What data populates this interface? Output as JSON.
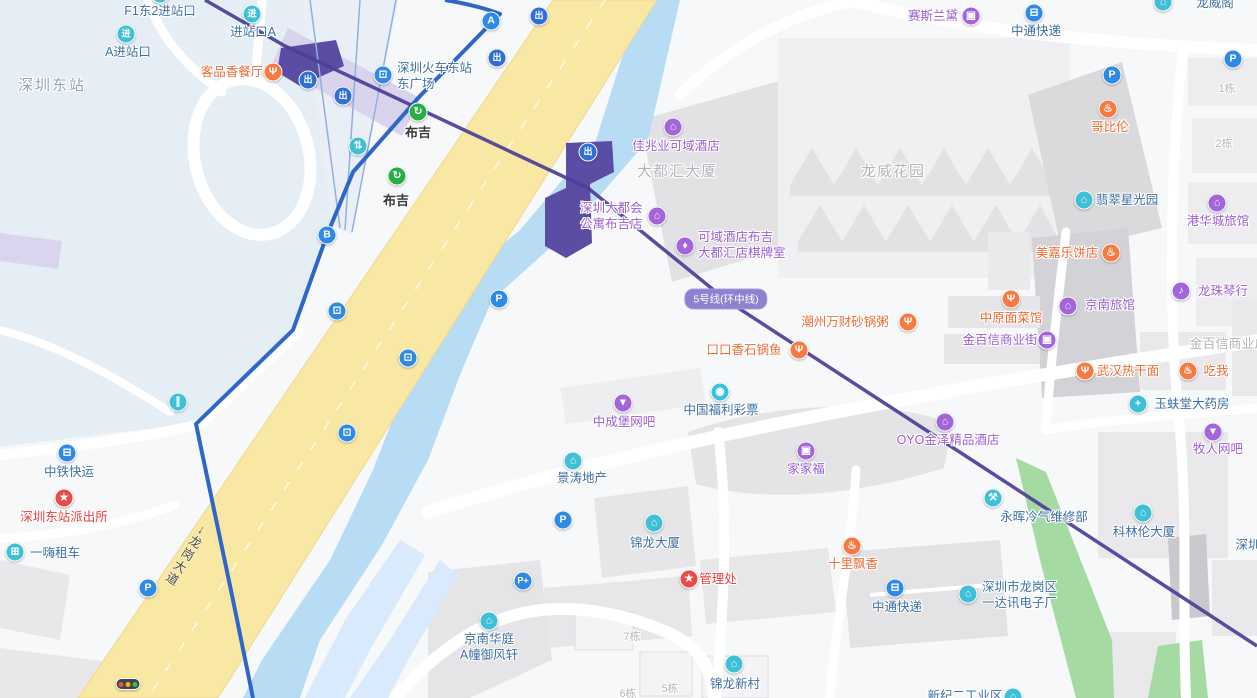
{
  "map_title": "深圳东站 / 布吉站周边地图",
  "palette": {
    "icon": {
      "blue": "#2f8ae4",
      "teal": "#3fc0d6",
      "green": "#27ae45",
      "purple": "#a465d8",
      "orange": "#f57b43",
      "red": "#e84c4a",
      "exit": "#2f6fd6"
    },
    "text": {
      "blue": "#3e6fa3",
      "purple": "#9c5ed2",
      "orange": "#ed6c35",
      "red": "#e3403e",
      "dark": "#38383a",
      "gray": "#b4b4ba",
      "grayblue": "#8fa7b5"
    },
    "road_yellow": "#f9e7a4",
    "river_blue": "#b9dcf5",
    "park_green": "#a5daa3",
    "metro_purple": "#4a3e96",
    "station_purple": "#5a4da3",
    "yard_blue": "#e4eef4"
  },
  "badge": {
    "text": "5号线(环中线)"
  },
  "road": {
    "name": "龙岗大道",
    "arrow": "↓"
  },
  "traffic_light": {
    "x": 128,
    "y": 684,
    "colors": [
      "#e85548",
      "#f2b01e",
      "#3dbb4e"
    ]
  },
  "pois": [
    {
      "id": "f1-east2-entrance",
      "lines": [
        "F1东2进站口"
      ],
      "align": "c",
      "x": 160,
      "y": 11,
      "tc": "blue",
      "icon": {
        "n": "entrance-icon",
        "g": "进",
        "c": "teal",
        "x": 160,
        "y": -6
      }
    },
    {
      "id": "entrance-a-top",
      "lines": [
        "进站口A"
      ],
      "align": "c",
      "x": 253,
      "y": 32,
      "tc": "blue",
      "icon": {
        "n": "entrance-icon",
        "g": "进",
        "c": "teal",
        "x": 252,
        "y": 14
      }
    },
    {
      "id": "a-entrance",
      "lines": [
        "A进站口"
      ],
      "align": "c",
      "x": 128,
      "y": 52,
      "tc": "blue",
      "icon": {
        "n": "entrance-icon",
        "g": "进",
        "c": "teal",
        "x": 126,
        "y": 34
      }
    },
    {
      "id": "shenzhen-east-station-area",
      "lines": [
        "深圳东站"
      ],
      "align": "c",
      "x": 52,
      "y": 86,
      "tc": "grayblue",
      "fs": 15,
      "ls": 2
    },
    {
      "id": "kepinxiang-restaurant",
      "lines": [
        "客品香餐厅"
      ],
      "align": "c",
      "x": 232,
      "y": 72,
      "tc": "orange",
      "icon": {
        "n": "restaurant-icon",
        "g": "Ψ",
        "c": "orange",
        "x": 273,
        "y": 72
      }
    },
    {
      "id": "east-square",
      "lines": [
        "深圳火车东站",
        "东广场"
      ],
      "align": "l",
      "x": 397,
      "y": 68,
      "tc": "blue",
      "icon": {
        "n": "bus-station-icon",
        "g": "⊡",
        "c": "blue",
        "x": 383,
        "y": 75
      }
    },
    {
      "id": "buji-metro-station-1",
      "lines": [
        "布吉"
      ],
      "align": "c",
      "x": 418,
      "y": 133,
      "tc": "dark",
      "fs": 13,
      "bold": true,
      "icon": {
        "n": "metro-icon",
        "g": "↻",
        "c": "green",
        "x": 418,
        "y": 112
      }
    },
    {
      "id": "buji-metro-station-2",
      "lines": [
        "布吉"
      ],
      "align": "c",
      "x": 396,
      "y": 201,
      "tc": "dark",
      "fs": 13,
      "bold": true,
      "icon": {
        "n": "metro-icon",
        "g": "↻",
        "c": "green",
        "x": 397,
        "y": 176
      }
    },
    {
      "id": "metropolis-apartment",
      "lines": [
        "深圳大都会",
        "公寓布吉店"
      ],
      "align": "l",
      "x": 580,
      "y": 208,
      "tc": "purple",
      "icon": {
        "n": "hotel-icon",
        "g": "⌂",
        "c": "purple",
        "x": 657,
        "y": 216
      }
    },
    {
      "id": "dadouhui-tower-area",
      "lines": [
        "大都汇大厦"
      ],
      "align": "c",
      "x": 677,
      "y": 172,
      "tc": "gray",
      "fs": 15,
      "ls": 1
    },
    {
      "id": "jiazhaoye-keyu-hotel",
      "lines": [
        "佳兆业可域酒店"
      ],
      "align": "c",
      "x": 676,
      "y": 146,
      "tc": "purple",
      "icon": {
        "n": "hotel-icon",
        "g": "⌂",
        "c": "purple",
        "x": 673,
        "y": 127
      }
    },
    {
      "id": "keyu-hotel-chess-room",
      "lines": [
        "可域酒店布吉",
        "大都汇店棋牌室"
      ],
      "align": "l",
      "x": 698,
      "y": 237,
      "tc": "purple",
      "icon": {
        "n": "poker-room-icon",
        "g": "♦",
        "c": "purple",
        "x": 685,
        "y": 246
      }
    },
    {
      "id": "longwei-garden-area",
      "lines": [
        "龙威花园"
      ],
      "align": "c",
      "x": 893,
      "y": 172,
      "tc": "gray",
      "fs": 15,
      "ls": 1
    },
    {
      "id": "saisilandai-cosmetics",
      "lines": [
        "赛斯兰黛"
      ],
      "align": "c",
      "x": 933,
      "y": 16,
      "tc": "purple",
      "icon": {
        "n": "cosmetics-icon",
        "g": "▣",
        "c": "purple",
        "x": 971,
        "y": 16
      }
    },
    {
      "id": "zhongtong-express-top",
      "lines": [
        "中通快递"
      ],
      "align": "c",
      "x": 1036,
      "y": 31,
      "tc": "blue",
      "icon": {
        "n": "truck-icon",
        "g": "⊟",
        "c": "blue",
        "x": 1034,
        "y": 13
      }
    },
    {
      "id": "longweige-partial",
      "lines": [
        "龙威阁"
      ],
      "align": "c",
      "x": 1215,
      "y": 3,
      "tc": "blue",
      "icon": {
        "n": "building-icon",
        "g": "⌂",
        "c": "teal",
        "x": 1163,
        "y": 2
      }
    },
    {
      "id": "gebilun-bakery",
      "lines": [
        "哥比伦"
      ],
      "align": "c",
      "x": 1110,
      "y": 127,
      "tc": "orange",
      "icon": {
        "n": "bakery-icon",
        "g": "♨",
        "c": "orange",
        "x": 1108,
        "y": 109
      }
    },
    {
      "id": "building-no-1",
      "lines": [
        "1栋"
      ],
      "align": "c",
      "x": 1227,
      "y": 89,
      "tc": "gray",
      "fs": 11
    },
    {
      "id": "building-no-2",
      "lines": [
        "2栋"
      ],
      "align": "c",
      "x": 1224,
      "y": 144,
      "tc": "gray",
      "fs": 11
    },
    {
      "id": "feicui-starlight-park",
      "lines": [
        "翡翠星光园"
      ],
      "align": "c",
      "x": 1127,
      "y": 200,
      "tc": "blue",
      "icon": {
        "n": "building-icon",
        "g": "⌂",
        "c": "teal",
        "x": 1084,
        "y": 200
      }
    },
    {
      "id": "ganghuacheng-hotel",
      "lines": [
        "港华城旅馆"
      ],
      "align": "c",
      "x": 1218,
      "y": 221,
      "tc": "purple",
      "icon": {
        "n": "hotel-icon",
        "g": "⌂",
        "c": "purple",
        "x": 1217,
        "y": 203
      }
    },
    {
      "id": "meijiale-bakery",
      "lines": [
        "美嘉乐饼店"
      ],
      "align": "c",
      "x": 1067,
      "y": 253,
      "tc": "orange",
      "icon": {
        "n": "bakery-icon",
        "g": "♨",
        "c": "orange",
        "x": 1111,
        "y": 253
      }
    },
    {
      "id": "jingnan-hotel",
      "lines": [
        "京南旅馆"
      ],
      "align": "c",
      "x": 1110,
      "y": 305,
      "tc": "purple",
      "icon": {
        "n": "hotel-icon",
        "g": "⌂",
        "c": "purple",
        "x": 1068,
        "y": 306
      }
    },
    {
      "id": "longzhu-piano-store",
      "lines": [
        "龙珠琴行"
      ],
      "align": "c",
      "x": 1223,
      "y": 291,
      "tc": "purple",
      "icon": {
        "n": "music-store-icon",
        "g": "♪",
        "c": "purple",
        "x": 1181,
        "y": 291
      }
    },
    {
      "id": "zhongyuan-noodle-restaurant",
      "lines": [
        "中原面菜馆"
      ],
      "align": "c",
      "x": 1011,
      "y": 318,
      "tc": "orange",
      "icon": {
        "n": "restaurant-icon",
        "g": "Ψ",
        "c": "orange",
        "x": 1011,
        "y": 299
      }
    },
    {
      "id": "jinbaixin-commercial-street",
      "lines": [
        "金百信商业街"
      ],
      "align": "c",
      "x": 1000,
      "y": 340,
      "tc": "purple",
      "icon": {
        "n": "shopping-icon",
        "g": "▣",
        "c": "purple",
        "x": 1047,
        "y": 340
      }
    },
    {
      "id": "jinbaixin-plaza-partial",
      "lines": [
        "金百信商业广场"
      ],
      "align": "c",
      "x": 1235,
      "y": 344,
      "tc": "gray",
      "fs": 13
    },
    {
      "id": "chaozhou-casserole-porridge",
      "lines": [
        "潮州万财砂锅粥"
      ],
      "align": "c",
      "x": 845,
      "y": 322,
      "tc": "orange",
      "icon": {
        "n": "restaurant-icon",
        "g": "Ψ",
        "c": "orange",
        "x": 908,
        "y": 322
      }
    },
    {
      "id": "koukouxiang-stone-pot-fish",
      "lines": [
        "口口香石锅鱼"
      ],
      "align": "c",
      "x": 744,
      "y": 350,
      "tc": "orange",
      "icon": {
        "n": "restaurant-icon",
        "g": "Ψ",
        "c": "orange",
        "x": 799,
        "y": 350
      }
    },
    {
      "id": "wuhan-hot-dry-noodles",
      "lines": [
        "武汉热干面"
      ],
      "align": "c",
      "x": 1128,
      "y": 371,
      "tc": "orange",
      "icon": {
        "n": "restaurant-icon",
        "g": "Ψ",
        "c": "orange",
        "x": 1085,
        "y": 371
      }
    },
    {
      "id": "chiwo-restaurant",
      "lines": [
        "吃我"
      ],
      "align": "c",
      "x": 1216,
      "y": 371,
      "tc": "orange",
      "icon": {
        "n": "snack-icon",
        "g": "♨",
        "c": "orange",
        "x": 1188,
        "y": 371
      }
    },
    {
      "id": "yufutang-pharmacy",
      "lines": [
        "玉蚨堂大药房"
      ],
      "align": "c",
      "x": 1192,
      "y": 404,
      "tc": "blue",
      "icon": {
        "n": "pharmacy-icon",
        "g": "+",
        "c": "teal",
        "x": 1138,
        "y": 404
      }
    },
    {
      "id": "muren-internet-bar",
      "lines": [
        "牧人网吧"
      ],
      "align": "c",
      "x": 1218,
      "y": 449,
      "tc": "purple",
      "icon": {
        "n": "pin-icon",
        "g": "▼",
        "c": "purple",
        "x": 1213,
        "y": 432
      }
    },
    {
      "id": "zhongchengbao-internet-bar",
      "lines": [
        "中成堡网吧"
      ],
      "align": "c",
      "x": 624,
      "y": 422,
      "tc": "purple",
      "icon": {
        "n": "pin-icon",
        "g": "▼",
        "c": "purple",
        "x": 623,
        "y": 403
      }
    },
    {
      "id": "china-welfare-lottery",
      "lines": [
        "中国福利彩票"
      ],
      "align": "c",
      "x": 721,
      "y": 410,
      "tc": "blue",
      "icon": {
        "n": "lottery-icon",
        "g": "◉",
        "c": "teal",
        "x": 720,
        "y": 392
      }
    },
    {
      "id": "jingtao-real-estate",
      "lines": [
        "景涛地产"
      ],
      "align": "c",
      "x": 582,
      "y": 478,
      "tc": "blue",
      "icon": {
        "n": "building-icon",
        "g": "⌂",
        "c": "teal",
        "x": 573,
        "y": 461
      }
    },
    {
      "id": "jiajiafu-store",
      "lines": [
        "家家福"
      ],
      "align": "c",
      "x": 806,
      "y": 469,
      "tc": "purple",
      "icon": {
        "n": "shopping-icon",
        "g": "▣",
        "c": "purple",
        "x": 806,
        "y": 451
      }
    },
    {
      "id": "oyo-jinze-hotel",
      "lines": [
        "OYO金泽精品酒店"
      ],
      "align": "c",
      "x": 948,
      "y": 440,
      "tc": "purple",
      "icon": {
        "n": "hotel-icon",
        "g": "⌂",
        "c": "purple",
        "x": 945,
        "y": 422
      }
    },
    {
      "id": "yonghui-ac-repair",
      "lines": [
        "永晖冷气维修部"
      ],
      "align": "c",
      "x": 1044,
      "y": 517,
      "tc": "blue",
      "icon": {
        "n": "wrench-icon",
        "g": "⚒",
        "c": "teal",
        "x": 993,
        "y": 498
      }
    },
    {
      "id": "kelinlun-tower",
      "lines": [
        "科林伦大厦"
      ],
      "align": "c",
      "x": 1144,
      "y": 532,
      "tc": "blue",
      "icon": {
        "n": "building-icon",
        "g": "⌂",
        "c": "teal",
        "x": 1143,
        "y": 513
      }
    },
    {
      "id": "shenzhen-partial-right",
      "lines": [
        "深圳"
      ],
      "align": "c",
      "x": 1248,
      "y": 545,
      "tc": "blue"
    },
    {
      "id": "zhongtie-express",
      "lines": [
        "中铁快运"
      ],
      "align": "c",
      "x": 69,
      "y": 472,
      "tc": "blue",
      "icon": {
        "n": "truck-icon",
        "g": "⊟",
        "c": "blue",
        "x": 67,
        "y": 453
      }
    },
    {
      "id": "shenzhen-east-police-station",
      "lines": [
        "深圳东站派出所"
      ],
      "align": "c",
      "x": 64,
      "y": 517,
      "tc": "red",
      "icon": {
        "n": "police-icon",
        "g": "★",
        "c": "red",
        "x": 64,
        "y": 498
      }
    },
    {
      "id": "yihai-car-rental",
      "lines": [
        "一嗨租车"
      ],
      "align": "c",
      "x": 55,
      "y": 553,
      "tc": "blue",
      "icon": {
        "n": "car-icon",
        "g": "⊞",
        "c": "teal",
        "x": 15,
        "y": 552
      }
    },
    {
      "id": "jinlong-tower",
      "lines": [
        "锦龙大厦"
      ],
      "align": "c",
      "x": 655,
      "y": 543,
      "tc": "blue",
      "icon": {
        "n": "building-icon",
        "g": "⌂",
        "c": "teal",
        "x": 654,
        "y": 523
      }
    },
    {
      "id": "management-office",
      "lines": [
        "管理处"
      ],
      "align": "c",
      "x": 718,
      "y": 579,
      "tc": "red",
      "icon": {
        "n": "star-icon",
        "g": "★",
        "c": "red",
        "x": 689,
        "y": 579
      }
    },
    {
      "id": "shili-piaoxiang",
      "lines": [
        "十里飘香"
      ],
      "align": "c",
      "x": 853,
      "y": 564,
      "tc": "orange",
      "icon": {
        "n": "snack-icon",
        "g": "♨",
        "c": "orange",
        "x": 852,
        "y": 546
      }
    },
    {
      "id": "yidaxun-electronics-factory",
      "lines": [
        "深圳市龙岗区",
        "一达讯电子厂"
      ],
      "align": "l",
      "x": 982,
      "y": 587,
      "tc": "blue",
      "icon": {
        "n": "building-icon",
        "g": "⌂",
        "c": "teal",
        "x": 968,
        "y": 594
      }
    },
    {
      "id": "zhongtong-express-bottom",
      "lines": [
        "中通快递"
      ],
      "align": "c",
      "x": 897,
      "y": 607,
      "tc": "blue",
      "icon": {
        "n": "truck-icon",
        "g": "⊟",
        "c": "blue",
        "x": 895,
        "y": 588
      }
    },
    {
      "id": "jingnan-huating",
      "lines": [
        "京南华庭",
        "A幢御风轩"
      ],
      "align": "c",
      "x": 489,
      "y": 639,
      "tc": "blue",
      "icon": {
        "n": "building-icon",
        "g": "⌂",
        "c": "teal",
        "x": 489,
        "y": 621
      }
    },
    {
      "id": "building-no-7",
      "lines": [
        "7栋"
      ],
      "align": "c",
      "x": 632,
      "y": 637,
      "tc": "gray",
      "fs": 11
    },
    {
      "id": "building-no-5",
      "lines": [
        "5栋"
      ],
      "align": "c",
      "x": 670,
      "y": 689,
      "tc": "gray",
      "fs": 11
    },
    {
      "id": "building-no-6",
      "lines": [
        "6栋"
      ],
      "align": "c",
      "x": 628,
      "y": 694,
      "tc": "gray",
      "fs": 11
    },
    {
      "id": "jinlong-new-village",
      "lines": [
        "锦龙新村"
      ],
      "align": "c",
      "x": 735,
      "y": 684,
      "tc": "blue",
      "icon": {
        "n": "building-icon",
        "g": "⌂",
        "c": "teal",
        "x": 734,
        "y": 664
      }
    },
    {
      "id": "xinji-industrial-partial",
      "lines": [
        "新纪二工业区"
      ],
      "align": "c",
      "x": 965,
      "y": 696,
      "tc": "blue",
      "icon": {
        "n": "building-icon",
        "g": "⌂",
        "c": "teal",
        "x": 1013,
        "y": 697
      }
    }
  ],
  "icons": [
    {
      "n": "exit-icon",
      "g": "出",
      "c": "exit",
      "x": 308,
      "y": 80,
      "cjk": true
    },
    {
      "n": "exit-icon",
      "g": "出",
      "c": "exit",
      "x": 343,
      "y": 96,
      "cjk": true
    },
    {
      "n": "exit-icon",
      "g": "出",
      "c": "exit",
      "x": 497,
      "y": 58,
      "cjk": true
    },
    {
      "n": "exit-icon",
      "g": "出",
      "c": "exit",
      "x": 539,
      "y": 16,
      "cjk": true
    },
    {
      "n": "exit-icon",
      "g": "出",
      "c": "exit",
      "x": 588,
      "y": 152,
      "cjk": true
    },
    {
      "n": "exit-a-icon",
      "g": "A",
      "c": "blue",
      "x": 491,
      "y": 21
    },
    {
      "n": "exit-b-icon",
      "g": "B",
      "c": "blue",
      "x": 327,
      "y": 235
    },
    {
      "n": "transfer-icon",
      "g": "⇅",
      "c": "teal",
      "x": 358,
      "y": 146
    },
    {
      "n": "pedestrian-icon",
      "g": "∥",
      "c": "teal",
      "x": 178,
      "y": 402
    },
    {
      "n": "bus-stop-icon",
      "g": "⊡",
      "c": "blue",
      "x": 337,
      "y": 311
    },
    {
      "n": "bus-stop-icon",
      "g": "⊡",
      "c": "blue",
      "x": 408,
      "y": 358
    },
    {
      "n": "bus-stop-icon",
      "g": "⊡",
      "c": "blue",
      "x": 347,
      "y": 433
    },
    {
      "n": "parking-icon",
      "g": "P",
      "c": "blue",
      "x": 499,
      "y": 299
    },
    {
      "n": "parking-icon",
      "g": "P",
      "c": "blue",
      "x": 563,
      "y": 520
    },
    {
      "n": "parking-icon",
      "g": "P",
      "c": "blue",
      "x": 148,
      "y": 588
    },
    {
      "n": "parking-icon",
      "g": "P",
      "c": "blue",
      "x": 1112,
      "y": 75
    },
    {
      "n": "parking-icon",
      "g": "P",
      "c": "blue",
      "x": 1233,
      "y": 59
    },
    {
      "n": "parking-plus-icon",
      "g": "P+",
      "c": "blue",
      "x": 523,
      "y": 581,
      "cjk": true
    }
  ]
}
